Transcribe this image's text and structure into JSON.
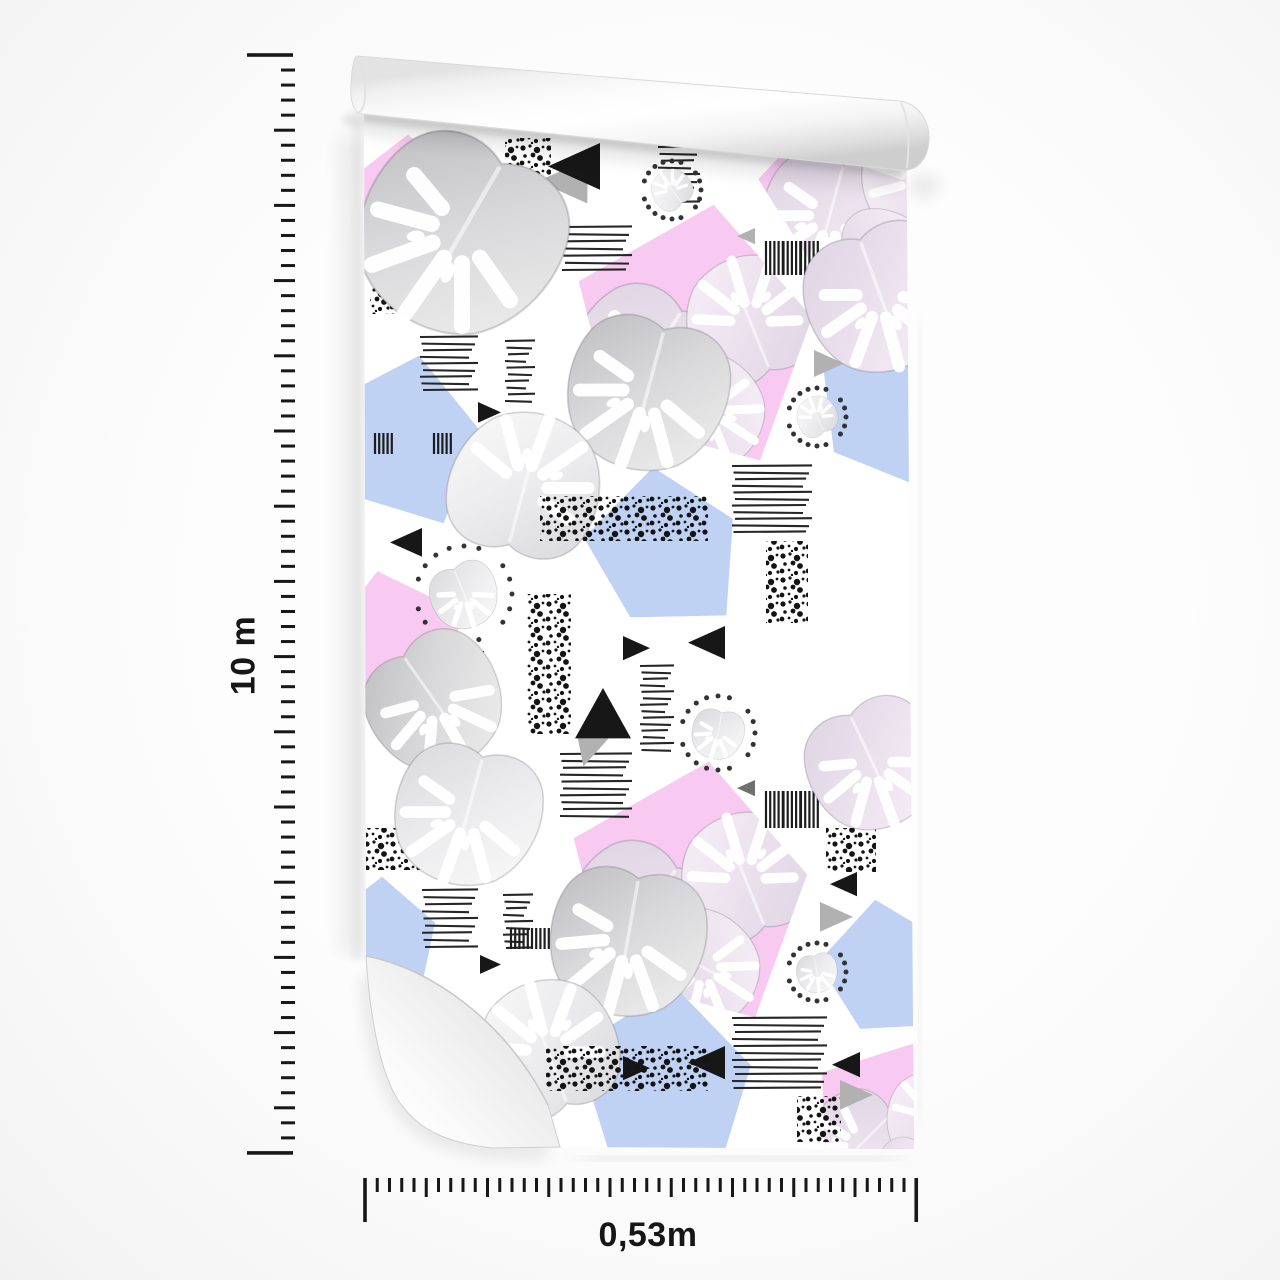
{
  "product": {
    "name": "wallpaper-roll-mockup",
    "length_label": "10 m",
    "width_label": "0,53m"
  },
  "rulers": {
    "vertical": {
      "label": "10 m",
      "x_right": 295,
      "y_start": 55,
      "y_end": 1153,
      "minor_spacing": 15.04,
      "major_every": 5,
      "minor_len": 14,
      "major_len": 21,
      "end_len": 46
    },
    "horizontal": {
      "label": "0,53m",
      "y_top": 1178,
      "x_start": 365,
      "x_end": 916,
      "minor_spacing": 12.25,
      "major_every": 5,
      "minor_len": 14,
      "major_len": 19,
      "end_len": 44
    }
  },
  "colors": {
    "tick": "#171717",
    "pink": "#f8c9f1",
    "blue": "#bfd2f4",
    "black_shape": "#171717",
    "gray_shape": "#b1b1b1",
    "dark_gray_shape": "#707070",
    "paper": "#ffffff"
  },
  "pattern": {
    "description": "memphis watercolor monstera leaves with pentagons, stripes, speckles, dotted circles, triangles",
    "elements": [
      {
        "t": "pent",
        "x": 870,
        "y": 195,
        "s": 115,
        "r": -10,
        "c": "pink"
      },
      {
        "t": "pent",
        "x": 408,
        "y": 208,
        "s": 72,
        "r": 0,
        "c": "pink"
      },
      {
        "t": "pent",
        "x": 695,
        "y": 338,
        "s": 132,
        "r": 8,
        "c": "pink"
      },
      {
        "t": "pent",
        "x": 398,
        "y": 648,
        "s": 78,
        "r": -15,
        "c": "pink"
      },
      {
        "t": "pent",
        "x": 690,
        "y": 895,
        "s": 132,
        "r": 8,
        "c": "pink"
      },
      {
        "t": "pent",
        "x": 893,
        "y": 1128,
        "s": 92,
        "r": 20,
        "c": "pink"
      },
      {
        "t": "pent",
        "x": 404,
        "y": 442,
        "s": 86,
        "r": 10,
        "c": "blue"
      },
      {
        "t": "pent",
        "x": 665,
        "y": 552,
        "s": 84,
        "r": -8,
        "c": "blue"
      },
      {
        "t": "pent",
        "x": 886,
        "y": 410,
        "s": 76,
        "r": 15,
        "c": "blue"
      },
      {
        "t": "pent",
        "x": 382,
        "y": 940,
        "s": 62,
        "r": 0,
        "c": "blue"
      },
      {
        "t": "pent",
        "x": 665,
        "y": 1085,
        "s": 98,
        "r": 5,
        "c": "blue"
      },
      {
        "t": "pent",
        "x": 888,
        "y": 972,
        "s": 72,
        "r": -10,
        "c": "blue"
      },
      {
        "t": "speck",
        "x": 505,
        "y": 138,
        "w": 46,
        "h": 78
      },
      {
        "t": "speck",
        "x": 370,
        "y": 270,
        "w": 102,
        "h": 44
      },
      {
        "t": "speck",
        "x": 826,
        "y": 270,
        "w": 50,
        "h": 47
      },
      {
        "t": "speck",
        "x": 527,
        "y": 594,
        "w": 44,
        "h": 140
      },
      {
        "t": "speck",
        "x": 766,
        "y": 541,
        "w": 42,
        "h": 82
      },
      {
        "t": "speck",
        "x": 366,
        "y": 828,
        "w": 105,
        "h": 42
      },
      {
        "t": "speck",
        "x": 797,
        "y": 1096,
        "w": 44,
        "h": 46
      },
      {
        "t": "speck",
        "x": 826,
        "y": 828,
        "w": 50,
        "h": 44
      },
      {
        "t": "stripes",
        "x": 562,
        "y": 227,
        "w": 70,
        "h": 43
      },
      {
        "t": "stripes",
        "x": 658,
        "y": 147,
        "w": 42,
        "h": 55
      },
      {
        "t": "stripes",
        "x": 420,
        "y": 337,
        "w": 58,
        "h": 53
      },
      {
        "t": "stripes",
        "x": 505,
        "y": 341,
        "w": 30,
        "h": 60
      },
      {
        "t": "stripes",
        "x": 732,
        "y": 466,
        "w": 80,
        "h": 66
      },
      {
        "t": "stripes",
        "x": 560,
        "y": 754,
        "w": 72,
        "h": 62
      },
      {
        "t": "stripes",
        "x": 640,
        "y": 666,
        "w": 34,
        "h": 84
      },
      {
        "t": "stripes",
        "x": 422,
        "y": 890,
        "w": 56,
        "h": 57
      },
      {
        "t": "stripes",
        "x": 503,
        "y": 895,
        "w": 30,
        "h": 53
      },
      {
        "t": "stripes",
        "x": 732,
        "y": 1018,
        "w": 95,
        "h": 70
      },
      {
        "t": "bar",
        "x": 766,
        "y": 241,
        "w": 52,
        "h": 34,
        "g": 3
      },
      {
        "t": "bar",
        "x": 375,
        "y": 433,
        "w": 76,
        "h": 21,
        "g": 2
      },
      {
        "t": "bar",
        "x": 766,
        "y": 791,
        "w": 52,
        "h": 37,
        "g": 3
      },
      {
        "t": "bar",
        "x": 466,
        "y": 651,
        "w": 30,
        "h": 52,
        "g": 1
      },
      {
        "t": "bar",
        "x": 511,
        "y": 928,
        "w": 38,
        "h": 21,
        "g": 2
      },
      {
        "t": "dots",
        "x": 672,
        "y": 190,
        "rr": 29
      },
      {
        "t": "dots",
        "x": 817,
        "y": 417,
        "rr": 29
      },
      {
        "t": "dots",
        "x": 464,
        "y": 594,
        "rr": 48
      },
      {
        "t": "dots",
        "x": 718,
        "y": 733,
        "rr": 37
      },
      {
        "t": "dots",
        "x": 817,
        "y": 972,
        "rr": 29
      },
      {
        "t": "arrowL",
        "x": 548,
        "y": 143,
        "s": 52
      },
      {
        "t": "arrowU",
        "x": 575,
        "y": 688,
        "s": 56
      },
      {
        "t": "tri",
        "x": 820,
        "y": 318,
        "s": 26,
        "dir": "left",
        "c": "black"
      },
      {
        "t": "tri",
        "x": 814,
        "y": 350,
        "s": 30,
        "dir": "right",
        "c": "gray"
      },
      {
        "t": "tri",
        "x": 737,
        "y": 228,
        "s": 18,
        "dir": "left",
        "c": "gray"
      },
      {
        "t": "tri",
        "x": 478,
        "y": 402,
        "s": 23,
        "dir": "right",
        "c": "black"
      },
      {
        "t": "tri",
        "x": 390,
        "y": 528,
        "s": 32,
        "dir": "left",
        "c": "black"
      },
      {
        "t": "tri",
        "x": 623,
        "y": 636,
        "s": 27,
        "dir": "right",
        "c": "black"
      },
      {
        "t": "tri",
        "x": 688,
        "y": 626,
        "s": 37,
        "dir": "left",
        "c": "black"
      },
      {
        "t": "tri",
        "x": 737,
        "y": 780,
        "s": 18,
        "dir": "left",
        "c": "dgray"
      },
      {
        "t": "tri",
        "x": 830,
        "y": 872,
        "s": 27,
        "dir": "left",
        "c": "black"
      },
      {
        "t": "tri",
        "x": 820,
        "y": 902,
        "s": 33,
        "dir": "right",
        "c": "gray"
      },
      {
        "t": "tri",
        "x": 480,
        "y": 955,
        "s": 21,
        "dir": "right",
        "c": "black"
      },
      {
        "t": "tri",
        "x": 623,
        "y": 1056,
        "s": 27,
        "dir": "right",
        "c": "black"
      },
      {
        "t": "tri",
        "x": 688,
        "y": 1046,
        "s": 37,
        "dir": "left",
        "c": "black"
      },
      {
        "t": "tri",
        "x": 832,
        "y": 1052,
        "s": 28,
        "dir": "left",
        "c": "black"
      },
      {
        "t": "tri",
        "x": 840,
        "y": 1080,
        "s": 33,
        "dir": "right",
        "c": "gray"
      },
      {
        "t": "leaf",
        "x": 462,
        "y": 232,
        "s": 215,
        "r": 30,
        "v": "dark"
      },
      {
        "t": "leaf",
        "x": 648,
        "y": 390,
        "s": 170,
        "r": 15,
        "v": "dark"
      },
      {
        "t": "leaf",
        "x": 880,
        "y": 295,
        "s": 160,
        "r": -20,
        "v": "pale"
      },
      {
        "t": "leaf",
        "x": 524,
        "y": 488,
        "s": 160,
        "r": 195,
        "v": "light"
      },
      {
        "t": "leaf",
        "x": 434,
        "y": 700,
        "s": 145,
        "r": -35,
        "v": "dark"
      },
      {
        "t": "leaf",
        "x": 468,
        "y": 812,
        "s": 155,
        "r": 15,
        "v": "light"
      },
      {
        "t": "leaf",
        "x": 628,
        "y": 938,
        "s": 165,
        "r": 10,
        "v": "dark"
      },
      {
        "t": "leaf",
        "x": 872,
        "y": 762,
        "s": 140,
        "r": -25,
        "v": "pale"
      },
      {
        "t": "leaf",
        "x": 548,
        "y": 1052,
        "s": 150,
        "r": 160,
        "v": "light"
      },
      {
        "t": "speck",
        "x": 540,
        "y": 496,
        "w": 168,
        "h": 45
      },
      {
        "t": "speck",
        "x": 546,
        "y": 1046,
        "w": 162,
        "h": 45
      }
    ]
  }
}
